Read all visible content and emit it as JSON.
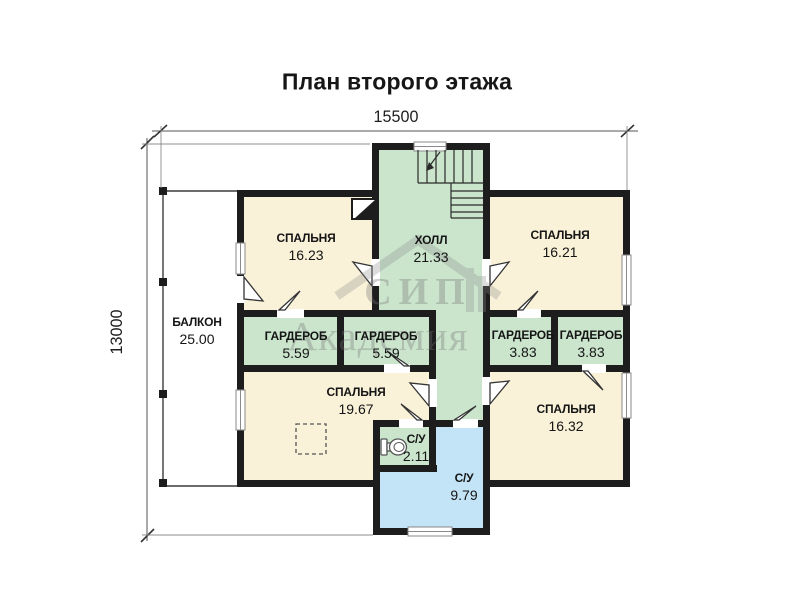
{
  "title": "План второго этажа",
  "dimensions": {
    "width_label": "15500",
    "height_label": "13000"
  },
  "watermark": {
    "line1": "СИП",
    "line2": "Академия"
  },
  "rooms": [
    {
      "id": "balcony",
      "name": "БАЛКОН",
      "area": "25.00"
    },
    {
      "id": "bedroom-16-23",
      "name": "СПАЛЬНЯ",
      "area": "16.23"
    },
    {
      "id": "hall",
      "name": "ХОЛЛ",
      "area": "21.33"
    },
    {
      "id": "bedroom-16-21",
      "name": "СПАЛЬНЯ",
      "area": "16.21"
    },
    {
      "id": "wardrobe-left",
      "name": "ГАРДЕРОБ",
      "area": "5.59"
    },
    {
      "id": "wardrobe-mid",
      "name": "ГАРДЕРОБ",
      "area": "5.59"
    },
    {
      "id": "wardrobe-right-1",
      "name": "ГАРДЕРОБ",
      "area": "3.83"
    },
    {
      "id": "wardrobe-right-2",
      "name": "ГАРДЕРОБ",
      "area": "3.83"
    },
    {
      "id": "bedroom-19-67",
      "name": "СПАЛЬНЯ",
      "area": "19.67"
    },
    {
      "id": "wc-small",
      "name": "С/У",
      "area": "2.11"
    },
    {
      "id": "wc-large",
      "name": "С/У",
      "area": "9.79"
    },
    {
      "id": "bedroom-16-32",
      "name": "СПАЛЬНЯ",
      "area": "16.32"
    }
  ],
  "colors": {
    "room_cream": "#f9f1d8",
    "room_green": "#cbe5cd",
    "room_blue": "#c3e3f6",
    "wall": "#1d1d1d"
  }
}
